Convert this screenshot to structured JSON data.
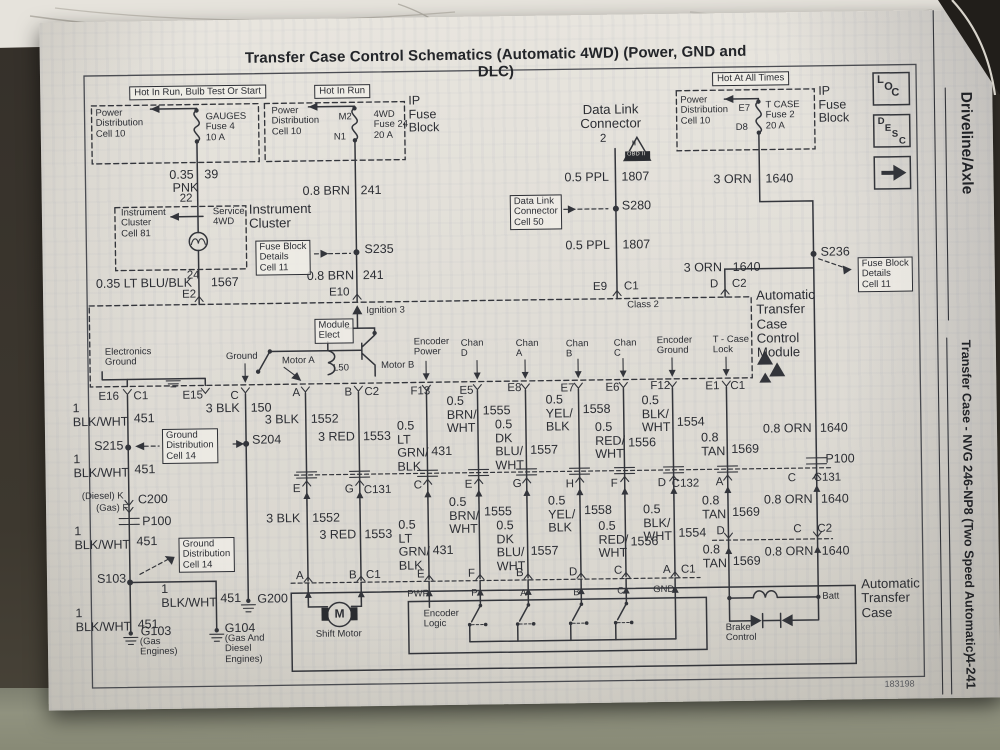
{
  "page": {
    "title": "Transfer Case Control Schematics (Automatic 4WD) (Power, GND and DLC)",
    "doc_number": "183198"
  },
  "margin": {
    "section": "Driveline/Axle",
    "subsection": "Transfer Case - NVG 246-NP8 (Two Speed Automatic)",
    "page_number": "4-241",
    "tabs": [
      "LOC",
      "DESC"
    ]
  },
  "schematic": {
    "labels": [
      {
        "t": "Hot In Run, Bulb Test Or Start",
        "x": 133,
        "y": 81,
        "c": "hdr"
      },
      {
        "t": "Hot In Run",
        "x": 318,
        "y": 82,
        "c": "hdr"
      },
      {
        "t": "Hot At All Times",
        "x": 716,
        "y": 75,
        "c": "hdr"
      },
      {
        "t": "Power\nDistribution\nCell 10",
        "x": 99,
        "y": 103,
        "c": "sm"
      },
      {
        "t": "GAUGES\nFuse 4\n10 A",
        "x": 209,
        "y": 108,
        "c": "sm"
      },
      {
        "t": "0.35",
        "x": 172,
        "y": 164
      },
      {
        "t": "39",
        "x": 207,
        "y": 164
      },
      {
        "t": "PNK",
        "x": 175,
        "y": 177
      },
      {
        "t": "22",
        "x": 182,
        "y": 188,
        "c": "pin"
      },
      {
        "t": "Power\nDistribution\nCell 10",
        "x": 275,
        "y": 103,
        "c": "sm"
      },
      {
        "t": "M2",
        "x": 342,
        "y": 110,
        "c": "sm"
      },
      {
        "t": "N1",
        "x": 337,
        "y": 130,
        "c": "sm"
      },
      {
        "t": "4WD\nFuse 24\n20 A",
        "x": 377,
        "y": 108,
        "c": "sm"
      },
      {
        "t": "IP\nFuse\nBlock",
        "x": 412,
        "y": 93
      },
      {
        "t": "0.8 BRN",
        "x": 305,
        "y": 182
      },
      {
        "t": "241",
        "x": 363,
        "y": 182
      },
      {
        "t": "S235",
        "x": 366,
        "y": 241
      },
      {
        "t": "0.8 BRN",
        "x": 308,
        "y": 267
      },
      {
        "t": "241",
        "x": 364,
        "y": 267
      },
      {
        "t": "E10",
        "x": 330,
        "y": 284,
        "c": "pin"
      },
      {
        "t": "Ignition 3",
        "x": 367,
        "y": 304,
        "c": "sm"
      },
      {
        "t": "Module\nElect",
        "x": 315,
        "y": 316,
        "c": "sm box"
      },
      {
        "t": "L50",
        "x": 333,
        "y": 361,
        "c": "sm"
      },
      {
        "t": "Instrument\nCluster\nCell 81",
        "x": 123,
        "y": 203,
        "c": "sm"
      },
      {
        "t": "Service\n4WD",
        "x": 215,
        "y": 203,
        "c": "sm"
      },
      {
        "t": "Instrument\nCluster",
        "x": 251,
        "y": 199,
        "c": "xl"
      },
      {
        "t": "Fuse Block\nDetails\nCell 11",
        "x": 257,
        "y": 237,
        "c": "sm box"
      },
      {
        "t": "24",
        "x": 188,
        "y": 265,
        "c": "pin"
      },
      {
        "t": "0.35 LT BLU/BLK",
        "x": 97,
        "y": 272
      },
      {
        "t": "1567",
        "x": 212,
        "y": 272
      },
      {
        "t": "E2",
        "x": 183,
        "y": 284,
        "c": "pin"
      },
      {
        "t": "Data Link\nConnector",
        "x": 583,
        "y": 104,
        "c": "xl ctr",
        "w": 62
      },
      {
        "t": "2",
        "x": 603,
        "y": 134,
        "c": "pin"
      },
      {
        "t": "II",
        "x": 635,
        "y": 142,
        "c": "tiny"
      },
      {
        "t": "OBD II",
        "x": 630,
        "y": 154,
        "c": "obd"
      },
      {
        "t": "0.5 PPL",
        "x": 567,
        "y": 172
      },
      {
        "t": "1807",
        "x": 624,
        "y": 172
      },
      {
        "t": "Data Link\nConnector\nCell 50",
        "x": 512,
        "y": 195,
        "c": "sm box"
      },
      {
        "t": "S280",
        "x": 624,
        "y": 201
      },
      {
        "t": "0.5 PPL",
        "x": 567,
        "y": 240
      },
      {
        "t": "1807",
        "x": 624,
        "y": 240
      },
      {
        "t": "E9",
        "x": 594,
        "y": 282,
        "c": "pin"
      },
      {
        "t": "C1",
        "x": 625,
        "y": 282,
        "c": "pin"
      },
      {
        "t": "Class 2",
        "x": 628,
        "y": 302,
        "c": "sm"
      },
      {
        "t": "Power\nDistribution\nCell 10",
        "x": 684,
        "y": 98,
        "c": "sm"
      },
      {
        "t": "E7",
        "x": 742,
        "y": 107,
        "c": "sm"
      },
      {
        "t": "D8",
        "x": 739,
        "y": 126,
        "c": "sm"
      },
      {
        "t": "T CASE\nFuse 2\n20 A",
        "x": 769,
        "y": 104,
        "c": "sm"
      },
      {
        "t": "IP\nFuse\nBlock",
        "x": 822,
        "y": 89
      },
      {
        "t": "3 ORN",
        "x": 716,
        "y": 176
      },
      {
        "t": "1640",
        "x": 768,
        "y": 176
      },
      {
        "t": "S236",
        "x": 822,
        "y": 250
      },
      {
        "t": "Fuse Block\nDetails\nCell 11",
        "x": 859,
        "y": 262,
        "c": "sm box"
      },
      {
        "t": "3 ORN",
        "x": 685,
        "y": 264
      },
      {
        "t": "1640",
        "x": 734,
        "y": 264
      },
      {
        "t": "D",
        "x": 711,
        "y": 281,
        "c": "pin"
      },
      {
        "t": "C2",
        "x": 733,
        "y": 281,
        "c": "pin"
      },
      {
        "t": "Automatic\nTransfer\nCase\nControl\nModule",
        "x": 757,
        "y": 292,
        "c": "xl"
      },
      {
        "t": "Electronics\nGround",
        "x": 105,
        "y": 342,
        "c": "sm"
      },
      {
        "t": "Ground",
        "x": 226,
        "y": 348,
        "c": "sm"
      },
      {
        "t": "Motor A",
        "x": 282,
        "y": 353,
        "c": "sm"
      },
      {
        "t": "Motor B",
        "x": 381,
        "y": 359,
        "c": "sm"
      },
      {
        "t": "Encoder\nPower",
        "x": 414,
        "y": 336,
        "c": "sm"
      },
      {
        "t": "Chan\nD",
        "x": 461,
        "y": 338,
        "c": "sm"
      },
      {
        "t": "Chan\nA",
        "x": 516,
        "y": 339,
        "c": "sm"
      },
      {
        "t": "Chan\nB",
        "x": 566,
        "y": 340,
        "c": "sm"
      },
      {
        "t": "Chan\nC",
        "x": 614,
        "y": 340,
        "c": "sm"
      },
      {
        "t": "Encoder\nGround",
        "x": 657,
        "y": 338,
        "c": "sm"
      },
      {
        "t": "T - Case\nLock",
        "x": 713,
        "y": 338,
        "c": "sm"
      },
      {
        "t": "E16",
        "x": 98,
        "y": 385,
        "c": "pin"
      },
      {
        "t": "C1",
        "x": 133,
        "y": 385,
        "c": "pin"
      },
      {
        "t": "E15",
        "x": 182,
        "y": 385,
        "c": "pin"
      },
      {
        "t": "C",
        "x": 230,
        "y": 386,
        "c": "pin"
      },
      {
        "t": "A",
        "x": 292,
        "y": 384,
        "c": "pin"
      },
      {
        "t": "B",
        "x": 344,
        "y": 384,
        "c": "pin"
      },
      {
        "t": "C2",
        "x": 364,
        "y": 384,
        "c": "pin"
      },
      {
        "t": "F13",
        "x": 410,
        "y": 384,
        "c": "pin"
      },
      {
        "t": "E5",
        "x": 459,
        "y": 384,
        "c": "pin"
      },
      {
        "t": "E8",
        "x": 507,
        "y": 382,
        "c": "pin"
      },
      {
        "t": "E7",
        "x": 560,
        "y": 383,
        "c": "pin"
      },
      {
        "t": "E6",
        "x": 605,
        "y": 383,
        "c": "pin"
      },
      {
        "t": "F12",
        "x": 650,
        "y": 382,
        "c": "pin"
      },
      {
        "t": "E1",
        "x": 705,
        "y": 383,
        "c": "pin"
      },
      {
        "t": "C1",
        "x": 730,
        "y": 383,
        "c": "pin"
      },
      {
        "t": "1\nBLK/WHT",
        "x": 72,
        "y": 396
      },
      {
        "t": "451",
        "x": 133,
        "y": 407
      },
      {
        "t": "S215",
        "x": 93,
        "y": 434
      },
      {
        "t": "Ground\nDistribution\nCell 14",
        "x": 161,
        "y": 424,
        "c": "sm box"
      },
      {
        "t": "S204",
        "x": 251,
        "y": 430
      },
      {
        "t": "3 BLK",
        "x": 205,
        "y": 398
      },
      {
        "t": "150",
        "x": 250,
        "y": 398
      },
      {
        "t": "1\nBLK/WHT",
        "x": 72,
        "y": 447
      },
      {
        "t": "451",
        "x": 133,
        "y": 458
      },
      {
        "t": "3 BLK",
        "x": 264,
        "y": 410
      },
      {
        "t": "1552",
        "x": 310,
        "y": 410
      },
      {
        "t": "3 RED",
        "x": 317,
        "y": 428
      },
      {
        "t": "1553",
        "x": 362,
        "y": 428
      },
      {
        "t": "0.5\nLT\nGRN/\nBLK",
        "x": 396,
        "y": 418
      },
      {
        "t": "431",
        "x": 430,
        "y": 444
      },
      {
        "t": "0.5\nBRN/\nWHT",
        "x": 446,
        "y": 394
      },
      {
        "t": "1555",
        "x": 482,
        "y": 404
      },
      {
        "t": "0.5\nDK\nBLU/\nWHT",
        "x": 494,
        "y": 418
      },
      {
        "t": "1557",
        "x": 529,
        "y": 444
      },
      {
        "t": "0.5\nYEL/\nBLK",
        "x": 545,
        "y": 394
      },
      {
        "t": "1558",
        "x": 582,
        "y": 404
      },
      {
        "t": "0.5\nRED/\nWHT",
        "x": 594,
        "y": 422
      },
      {
        "t": "1556",
        "x": 627,
        "y": 438
      },
      {
        "t": "0.5\nBLK/\nWHT",
        "x": 641,
        "y": 396
      },
      {
        "t": "1554",
        "x": 676,
        "y": 418
      },
      {
        "t": "0.8\nTAN",
        "x": 700,
        "y": 434
      },
      {
        "t": "1569",
        "x": 730,
        "y": 446
      },
      {
        "t": "0.8 ORN",
        "x": 762,
        "y": 426
      },
      {
        "t": "1640",
        "x": 819,
        "y": 426
      },
      {
        "t": "E",
        "x": 291,
        "y": 480,
        "c": "pin"
      },
      {
        "t": "G",
        "x": 343,
        "y": 481,
        "c": "pin"
      },
      {
        "t": "C131",
        "x": 362,
        "y": 482,
        "c": "pin"
      },
      {
        "t": "C",
        "x": 412,
        "y": 478,
        "c": "pin"
      },
      {
        "t": "E",
        "x": 463,
        "y": 478,
        "c": "pin"
      },
      {
        "t": "G",
        "x": 511,
        "y": 478,
        "c": "pin"
      },
      {
        "t": "H",
        "x": 564,
        "y": 479,
        "c": "pin"
      },
      {
        "t": "F",
        "x": 609,
        "y": 479,
        "c": "pin"
      },
      {
        "t": "D",
        "x": 656,
        "y": 479,
        "c": "pin"
      },
      {
        "t": "C132",
        "x": 670,
        "y": 480,
        "c": "pin"
      },
      {
        "t": "A",
        "x": 714,
        "y": 479,
        "c": "pin"
      },
      {
        "t": "P100",
        "x": 824,
        "y": 457
      },
      {
        "t": "C",
        "x": 786,
        "y": 476,
        "c": "pin"
      },
      {
        "t": "C131",
        "x": 812,
        "y": 476,
        "c": "pin"
      },
      {
        "t": "3 BLK",
        "x": 264,
        "y": 509
      },
      {
        "t": "1552",
        "x": 310,
        "y": 509
      },
      {
        "t": "3 RED",
        "x": 317,
        "y": 526
      },
      {
        "t": "1553",
        "x": 362,
        "y": 526
      },
      {
        "t": "0.5\nLT\nGRN/\nBLK",
        "x": 396,
        "y": 517
      },
      {
        "t": "431",
        "x": 430,
        "y": 543
      },
      {
        "t": "0.5\nBRN/\nWHT",
        "x": 447,
        "y": 495
      },
      {
        "t": "1555",
        "x": 482,
        "y": 505
      },
      {
        "t": "0.5\nDK\nBLU/\nWHT",
        "x": 494,
        "y": 519
      },
      {
        "t": "1557",
        "x": 528,
        "y": 545
      },
      {
        "t": "0.5\nYEL/\nBLK",
        "x": 546,
        "y": 495
      },
      {
        "t": "1558",
        "x": 582,
        "y": 505
      },
      {
        "t": "0.5\nRED/\nWHT",
        "x": 596,
        "y": 521
      },
      {
        "t": "1556",
        "x": 628,
        "y": 537
      },
      {
        "t": "0.5\nBLK/\nWHT",
        "x": 641,
        "y": 505
      },
      {
        "t": "1554",
        "x": 676,
        "y": 529
      },
      {
        "t": "D",
        "x": 714,
        "y": 528,
        "c": "pin"
      },
      {
        "t": "0.8\nTAN",
        "x": 700,
        "y": 497
      },
      {
        "t": "1569",
        "x": 730,
        "y": 509
      },
      {
        "t": "0.8 ORN",
        "x": 762,
        "y": 497
      },
      {
        "t": "1640",
        "x": 819,
        "y": 497
      },
      {
        "t": "C",
        "x": 791,
        "y": 527,
        "c": "pin"
      },
      {
        "t": "C2",
        "x": 815,
        "y": 527,
        "c": "pin"
      },
      {
        "t": "0.8\nTAN",
        "x": 700,
        "y": 546
      },
      {
        "t": "1569",
        "x": 730,
        "y": 558
      },
      {
        "t": "0.8 ORN",
        "x": 762,
        "y": 549
      },
      {
        "t": "1640",
        "x": 819,
        "y": 549
      },
      {
        "t": "A",
        "x": 293,
        "y": 567,
        "c": "pin"
      },
      {
        "t": "B",
        "x": 346,
        "y": 567,
        "c": "pin"
      },
      {
        "t": "C1",
        "x": 363,
        "y": 567,
        "c": "pin"
      },
      {
        "t": "E",
        "x": 414,
        "y": 567,
        "c": "pin"
      },
      {
        "t": "F",
        "x": 465,
        "y": 567,
        "c": "pin"
      },
      {
        "t": "B",
        "x": 513,
        "y": 567,
        "c": "pin"
      },
      {
        "t": "D",
        "x": 566,
        "y": 567,
        "c": "pin"
      },
      {
        "t": "C",
        "x": 611,
        "y": 566,
        "c": "pin"
      },
      {
        "t": "A",
        "x": 660,
        "y": 566,
        "c": "pin"
      },
      {
        "t": "C1",
        "x": 678,
        "y": 566,
        "c": "pin"
      },
      {
        "t": "PWR",
        "x": 404,
        "y": 588,
        "c": "sm"
      },
      {
        "t": "P",
        "x": 468,
        "y": 588,
        "c": "sm"
      },
      {
        "t": "A",
        "x": 517,
        "y": 589,
        "c": "sm"
      },
      {
        "t": "B",
        "x": 570,
        "y": 589,
        "c": "sm"
      },
      {
        "t": "C",
        "x": 614,
        "y": 588,
        "c": "sm"
      },
      {
        "t": "GND",
        "x": 650,
        "y": 587,
        "c": "sm"
      },
      {
        "t": "Encoder\nLogic",
        "x": 420,
        "y": 608,
        "c": "sm"
      },
      {
        "t": "M",
        "x": 331,
        "y": 605,
        "c": "m"
      },
      {
        "t": "Shift Motor",
        "x": 312,
        "y": 627,
        "c": "sm"
      },
      {
        "t": "Brake\nControl",
        "x": 722,
        "y": 626,
        "c": "sm"
      },
      {
        "t": "Batt",
        "x": 819,
        "y": 596,
        "c": "sm"
      },
      {
        "t": "Automatic\nTransfer\nCase",
        "x": 858,
        "y": 582,
        "c": "xl"
      },
      {
        "t": "(Diesel) K",
        "x": 80,
        "y": 486,
        "c": "sm"
      },
      {
        "t": "(Gas) F",
        "x": 94,
        "y": 498,
        "c": "sm"
      },
      {
        "t": "C200",
        "x": 136,
        "y": 488
      },
      {
        "t": "P100",
        "x": 140,
        "y": 510
      },
      {
        "t": "1\nBLK/WHT",
        "x": 72,
        "y": 519
      },
      {
        "t": "451",
        "x": 134,
        "y": 530
      },
      {
        "t": "Ground\nDistribution\nCell 14",
        "x": 176,
        "y": 533,
        "c": "sm box"
      },
      {
        "t": "S103",
        "x": 94,
        "y": 567
      },
      {
        "t": "1\nBLK/WHT",
        "x": 158,
        "y": 578
      },
      {
        "t": "451",
        "x": 217,
        "y": 588
      },
      {
        "t": "G200",
        "x": 254,
        "y": 589
      },
      {
        "t": "1\nBLK/WHT",
        "x": 72,
        "y": 601
      },
      {
        "t": "451",
        "x": 134,
        "y": 613
      },
      {
        "t": "G103",
        "x": 137,
        "y": 620
      },
      {
        "t": "(Gas\nEngines)",
        "x": 136,
        "y": 632,
        "c": "sm"
      },
      {
        "t": "G104",
        "x": 221,
        "y": 618
      },
      {
        "t": "(Gas And\nDiesel\nEngines)",
        "x": 221,
        "y": 630,
        "c": "sm"
      }
    ]
  }
}
